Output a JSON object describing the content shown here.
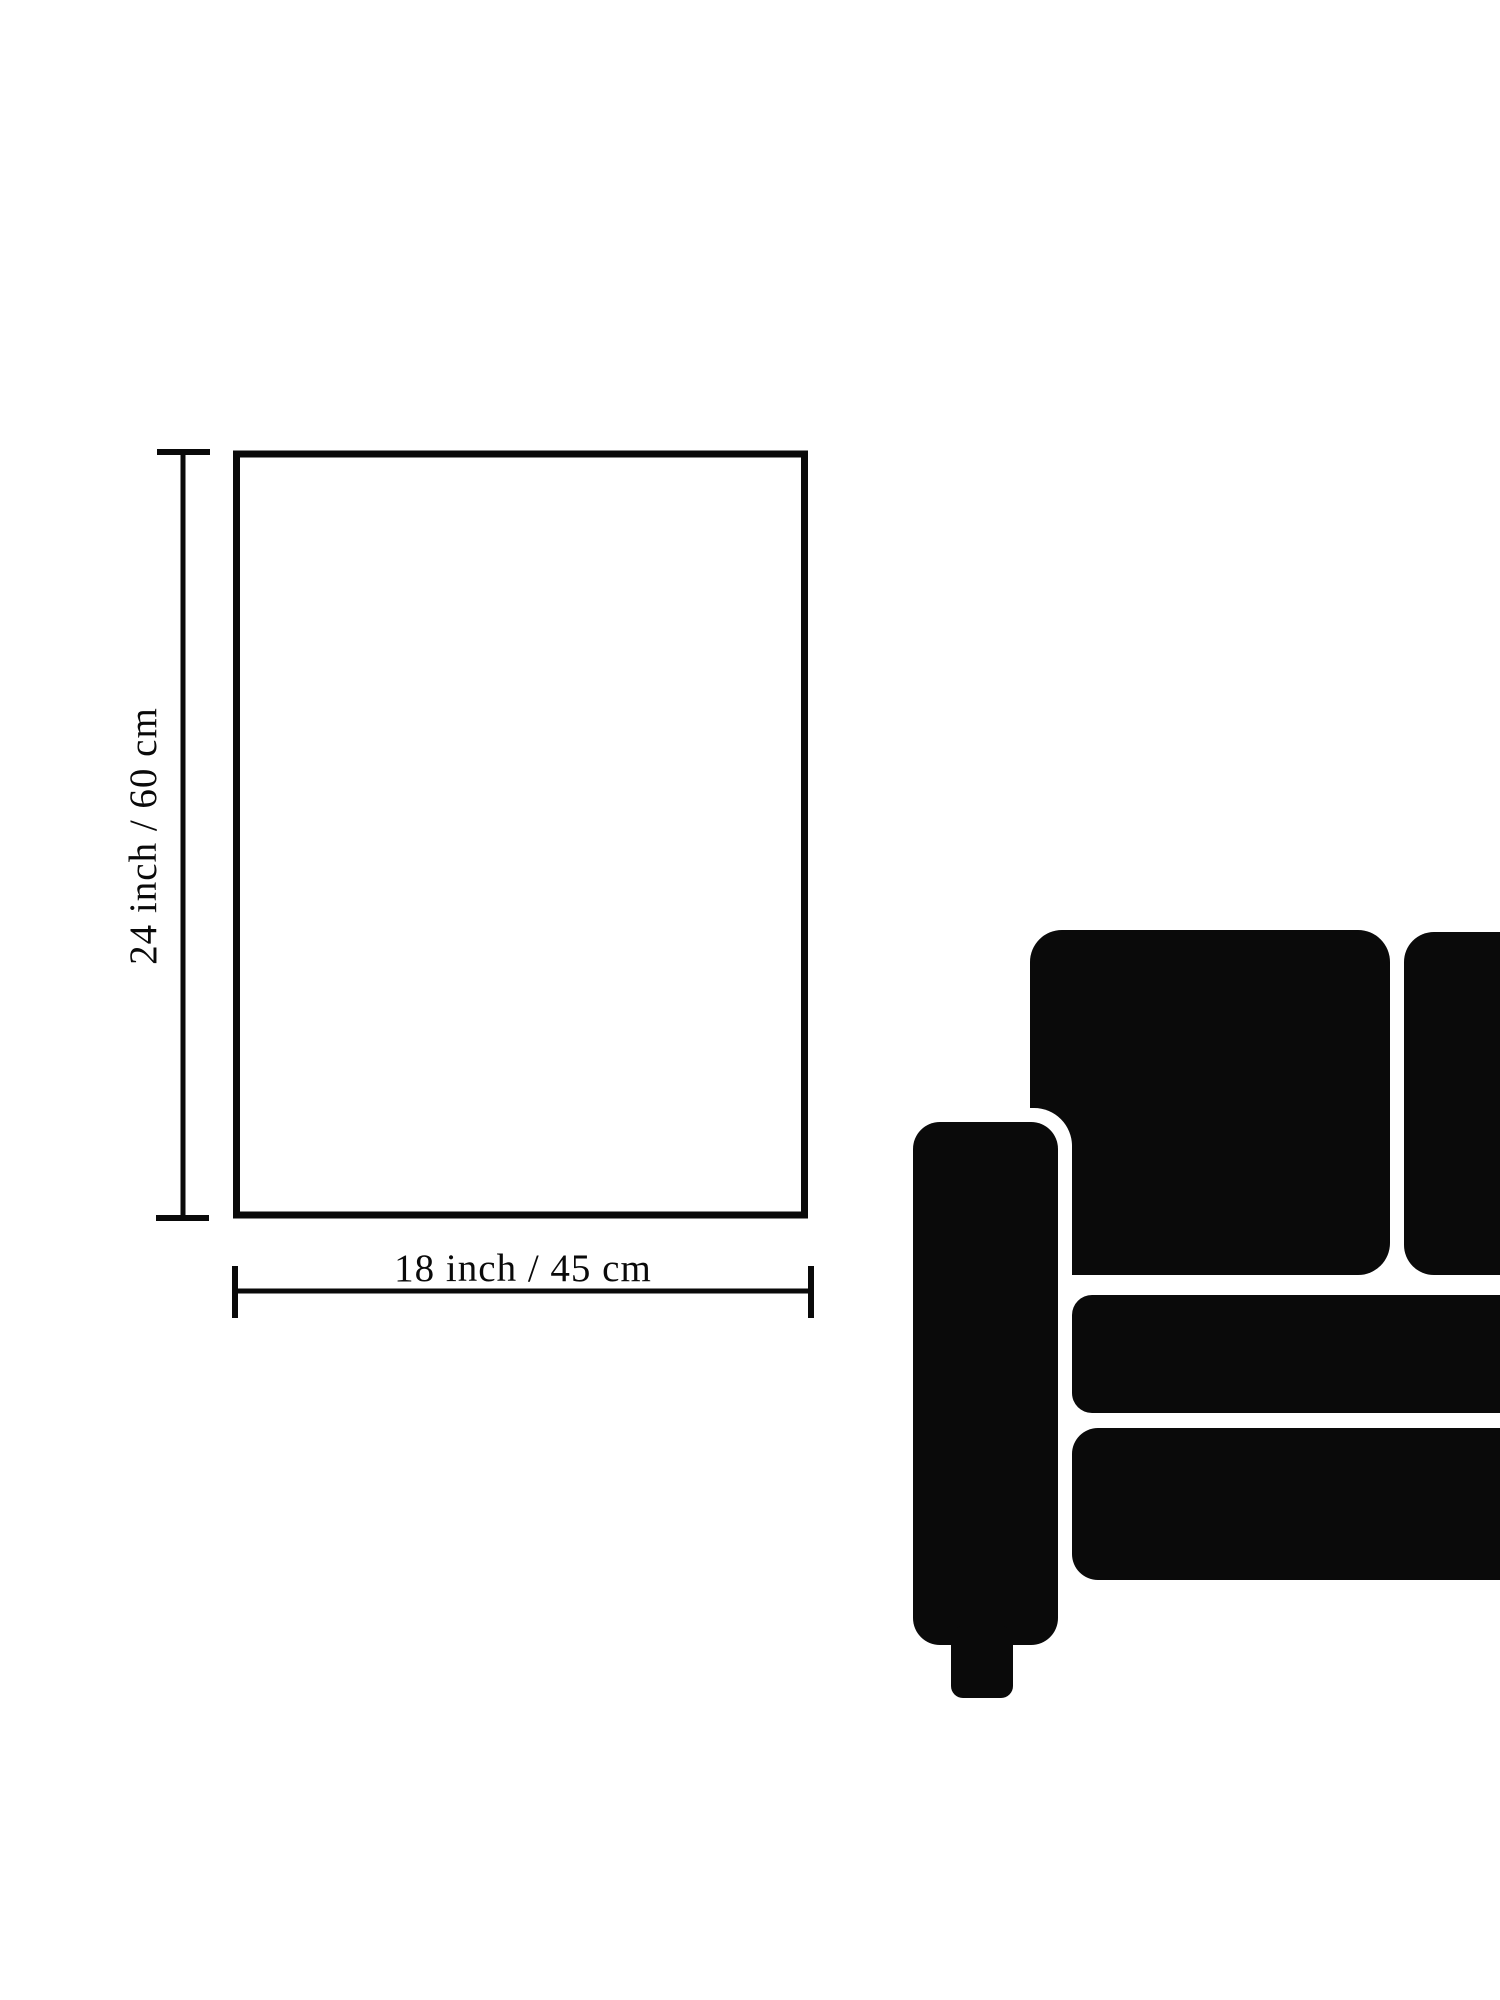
{
  "labels": {
    "height": "24 inch / 60 cm",
    "width": "18 inch / 45 cm"
  },
  "colors": {
    "ink": "#0a0a0a",
    "background": "#ffffff"
  }
}
